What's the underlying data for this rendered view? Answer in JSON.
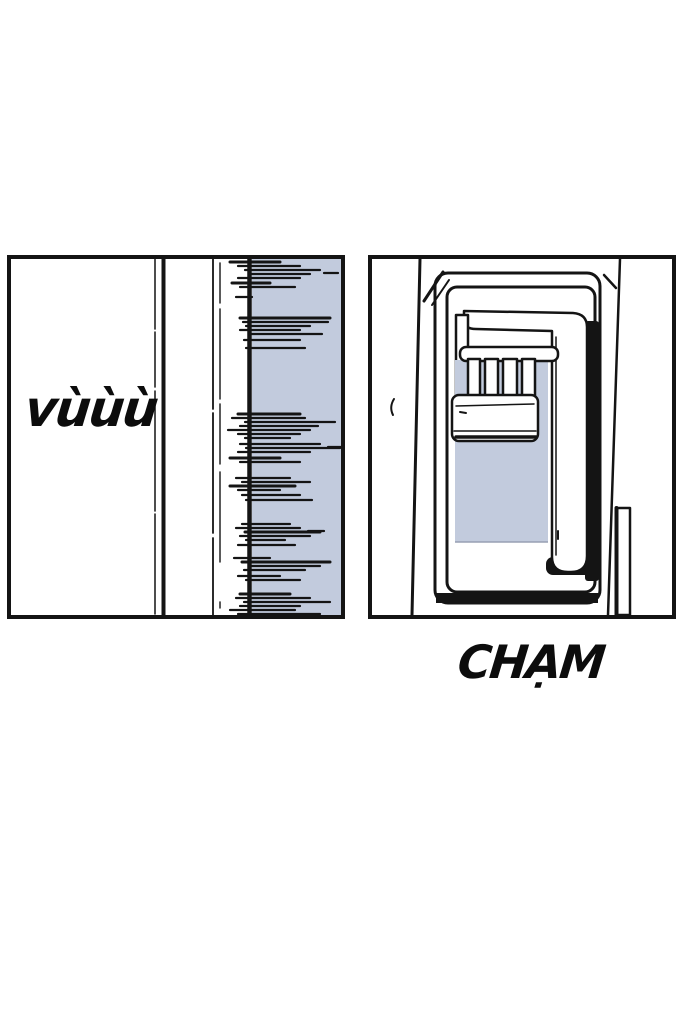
{
  "page": {
    "width": 700,
    "height": 1018,
    "background": "#ffffff"
  },
  "ink_color": "#141414",
  "shade_color": "#c2cbdd",
  "panels": {
    "left": {
      "sfx": "vùùù",
      "speed_lines": [
        [
          3,
          219,
          269,
          3
        ],
        [
          7,
          227,
          289
        ],
        [
          11,
          234,
          309
        ],
        [
          14,
          313,
          327
        ],
        [
          15,
          239,
          299
        ],
        [
          19,
          227,
          289
        ],
        [
          24,
          221,
          259,
          3
        ],
        [
          28,
          229,
          284
        ],
        [
          38,
          225,
          241
        ],
        [
          59,
          229,
          319,
          3
        ],
        [
          63,
          232,
          317
        ],
        [
          67,
          235,
          299
        ],
        [
          71,
          229,
          289
        ],
        [
          75,
          239,
          311
        ],
        [
          81,
          233,
          289
        ],
        [
          89,
          235,
          294
        ],
        [
          155,
          227,
          289,
          3
        ],
        [
          159,
          221,
          294
        ],
        [
          163,
          234,
          324
        ],
        [
          167,
          229,
          307
        ],
        [
          171,
          217,
          299
        ],
        [
          175,
          227,
          289
        ],
        [
          179,
          234,
          279
        ],
        [
          185,
          229,
          309
        ],
        [
          188,
          317,
          335
        ],
        [
          189,
          235,
          329
        ],
        [
          193,
          227,
          299
        ],
        [
          199,
          219,
          269,
          3
        ],
        [
          203,
          229,
          289
        ],
        [
          219,
          225,
          279
        ],
        [
          223,
          231,
          299
        ],
        [
          227,
          219,
          284,
          3
        ],
        [
          231,
          227,
          269
        ],
        [
          236,
          231,
          289
        ],
        [
          241,
          235,
          301
        ],
        [
          265,
          231,
          279
        ],
        [
          269,
          225,
          289
        ],
        [
          272,
          297,
          313
        ],
        [
          273,
          234,
          309,
          3
        ],
        [
          277,
          229,
          299
        ],
        [
          281,
          235,
          274
        ],
        [
          286,
          227,
          284
        ],
        [
          299,
          223,
          259
        ],
        [
          303,
          231,
          319,
          3
        ],
        [
          307,
          239,
          309
        ],
        [
          311,
          233,
          294
        ],
        [
          317,
          227,
          269
        ],
        [
          321,
          235,
          289
        ],
        [
          335,
          229,
          279,
          3
        ],
        [
          339,
          225,
          299
        ],
        [
          343,
          233,
          319
        ],
        [
          347,
          229,
          289
        ],
        [
          351,
          219,
          284
        ],
        [
          355,
          227,
          309
        ]
      ]
    },
    "right": {
      "sfx": "CHẠM"
    }
  }
}
